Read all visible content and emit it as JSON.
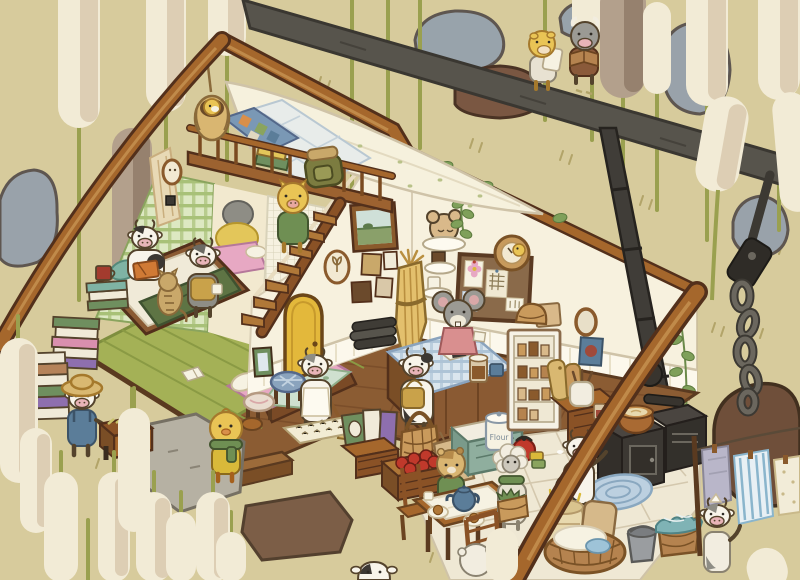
{
  "scene": {
    "title": "Cozy A-frame cabin cutaway among giant cattails",
    "style": "hand-drawn cozy game illustration, isometric cutaway",
    "labels": {
      "flour_canister": "Flour"
    },
    "palette": {
      "background": "#d7cb9c",
      "cattail_cream": "#f2ebd6",
      "cattail_brown": "#b3a08c",
      "stem_green": "#9aa04f",
      "wood_beam": "#a5672c",
      "wood_outline": "#53301b",
      "wall_cream": "#f7f1de",
      "floor_wood": "#8b5c33",
      "mat_green": "#a4b156",
      "tile": "#efe8d4",
      "door_yellow": "#e3b83b",
      "dark_beam_gray": "#57544c",
      "stove_black": "#38342e",
      "rock_gray": "#99a2aa",
      "rock_brown": "#6f4f3a",
      "bed_pink": "#e7a8c3",
      "blanket_green": "#5e7444",
      "plaid_blue": "#dbe6ee",
      "apron_pink": "#d98f8f"
    },
    "characters": [
      {
        "id": "cow-reading",
        "species": "cow",
        "detail": "black-and-white cow reading an orange book in bed",
        "location": "bedroom"
      },
      {
        "id": "tabby-cat",
        "species": "cat",
        "detail": "tabby cat sitting beside the bed",
        "location": "bedroom"
      },
      {
        "id": "calf-with-mug",
        "species": "calf",
        "detail": "gray calf in mustard vest holding a mug",
        "location": "bedroom"
      },
      {
        "id": "duck-in-hanging-basket",
        "species": "duckling",
        "detail": "yellow duckling nestled in hanging woven basket",
        "location": "loft"
      },
      {
        "id": "pig-on-stairs",
        "species": "pig",
        "detail": "yellow pig in green sweater climbing loft stairs",
        "location": "loft stairs"
      },
      {
        "id": "mouse-shopkeeper",
        "species": "mouse",
        "detail": "gray mouse in pink apron behind plaid counter",
        "location": "shop room"
      },
      {
        "id": "cow-customer",
        "species": "cow",
        "detail": "cow with tan satchel standing at counter",
        "location": "shop room"
      },
      {
        "id": "cow-sweeping",
        "species": "cow",
        "detail": "cow in white apron sweeping with a broom",
        "location": "near door"
      },
      {
        "id": "duck-villager",
        "species": "duck",
        "detail": "yellow duck with green scarf on stepping stone",
        "location": "outside entrance"
      },
      {
        "id": "cow-farmer",
        "species": "cow",
        "detail": "cow in straw hat and blue overalls pushing hay trough",
        "location": "outside left"
      },
      {
        "id": "calf-carrying-parcel",
        "species": "calf",
        "detail": "yellow calf carrying a white parcel",
        "location": "outside top right"
      },
      {
        "id": "calf-reading-walking",
        "species": "calf",
        "detail": "gray calf in brown vest reading while walking",
        "location": "outside top right"
      },
      {
        "id": "hamster-eating",
        "species": "hamster",
        "detail": "tan hamster eating at the dining table",
        "location": "kitchen"
      },
      {
        "id": "sheep-with-basket",
        "species": "sheep",
        "detail": "gray sheep with green scarf holding a basket of greens",
        "location": "kitchen"
      },
      {
        "id": "diner-back",
        "species": "villager",
        "detail": "white-furred villager seen from behind at table",
        "location": "kitchen"
      },
      {
        "id": "cow-cooking",
        "species": "cow",
        "detail": "cow stirring a copper pot at the wood stove",
        "location": "kitchen"
      },
      {
        "id": "cow-laundry",
        "species": "cow",
        "detail": "gray cow with white kerchief hanging towels",
        "location": "outside right"
      },
      {
        "id": "cow-peeking",
        "species": "cow",
        "detail": "tiny cow peeking from among the cattails",
        "location": "bottom edge"
      }
    ],
    "rooms": {
      "bedroom": [
        "loft bed with white canopy",
        "patchwork quilt",
        "stack of books on bed",
        "hanging basket chair",
        "green plaid curtain",
        "mesh curtain",
        "sleeping nook with futon",
        "reading bed",
        "pink bed",
        "woven green floor mat",
        "book stacks with red mug",
        "loft ladder stairs",
        "green backpack"
      ],
      "shop_room": [
        "yellow arched door",
        "landscape painting",
        "oval tulip frame",
        "small picture frames",
        "dried wheat bundle",
        "wall shelves with mouse-shaped pastry",
        "chocolate plate",
        "candle shelf",
        "cork bulletin board with notes",
        "duck wall clock",
        "vine garlands",
        "plaid service counter",
        "open ledger",
        "jam jar",
        "blue cup",
        "newspaper rolls",
        "plaid stool",
        "cream stool",
        "doormat",
        "record crate with books",
        "woven basket",
        "grain sack",
        "apple crate"
      ],
      "kitchen": [
        "flour counter",
        "flour canister",
        "red kettle",
        "stacked cups",
        "white pantry cabinet with jars",
        "basket and box on pantry",
        "cutting boards",
        "utensil crock",
        "wood stove",
        "stovepipe",
        "copper pot",
        "hanging pan",
        "braided blue rug",
        "bun tray",
        "dining table with cloth",
        "blue teapot",
        "tart plates",
        "wooden chairs",
        "straw sack",
        "grain sacks",
        "laundry basket with linens",
        "gray bucket",
        "basket with teal cloth"
      ],
      "outside": [
        "giant cattails",
        "gray rocks",
        "brown rocks",
        "stepping stones",
        "dark timber beam",
        "iron chain",
        "clothesline with three towels",
        "hay trough cart"
      ]
    }
  }
}
